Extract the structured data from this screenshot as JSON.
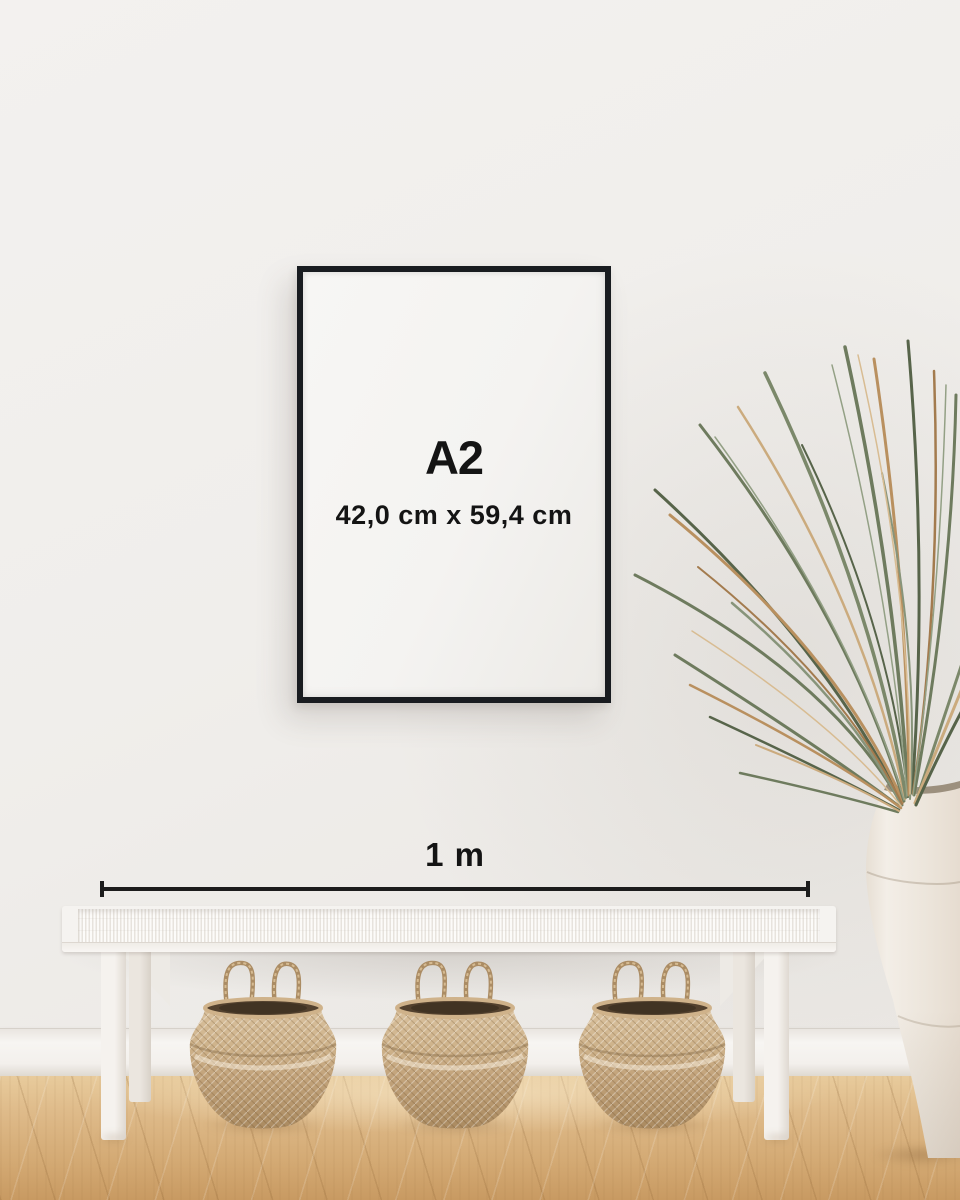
{
  "frame": {
    "size_label": "A2",
    "dimensions_label": "42,0 cm x 59,4 cm"
  },
  "measurement": {
    "label": "1 m"
  },
  "colors": {
    "wall": "#f1efec",
    "baseboard": "#f6f4f0",
    "floor_mid": "#dcb684",
    "frame_border": "#191c20",
    "poster": "#f5f4f2",
    "text": "#141414",
    "measure_line": "#1c1c1c",
    "bench_white": "#f5f3f0",
    "basket_light": "#d9c19e",
    "basket_mid": "#c3a47c",
    "basket_dark": "#aa8a60",
    "basket_opening": "#53412e",
    "plant_green": "#6e7b5e",
    "plant_green_dark": "#57644a",
    "plant_dry": "#b9905f",
    "vase_light": "#f3eee7",
    "vase_shade": "#ddd3c7"
  }
}
